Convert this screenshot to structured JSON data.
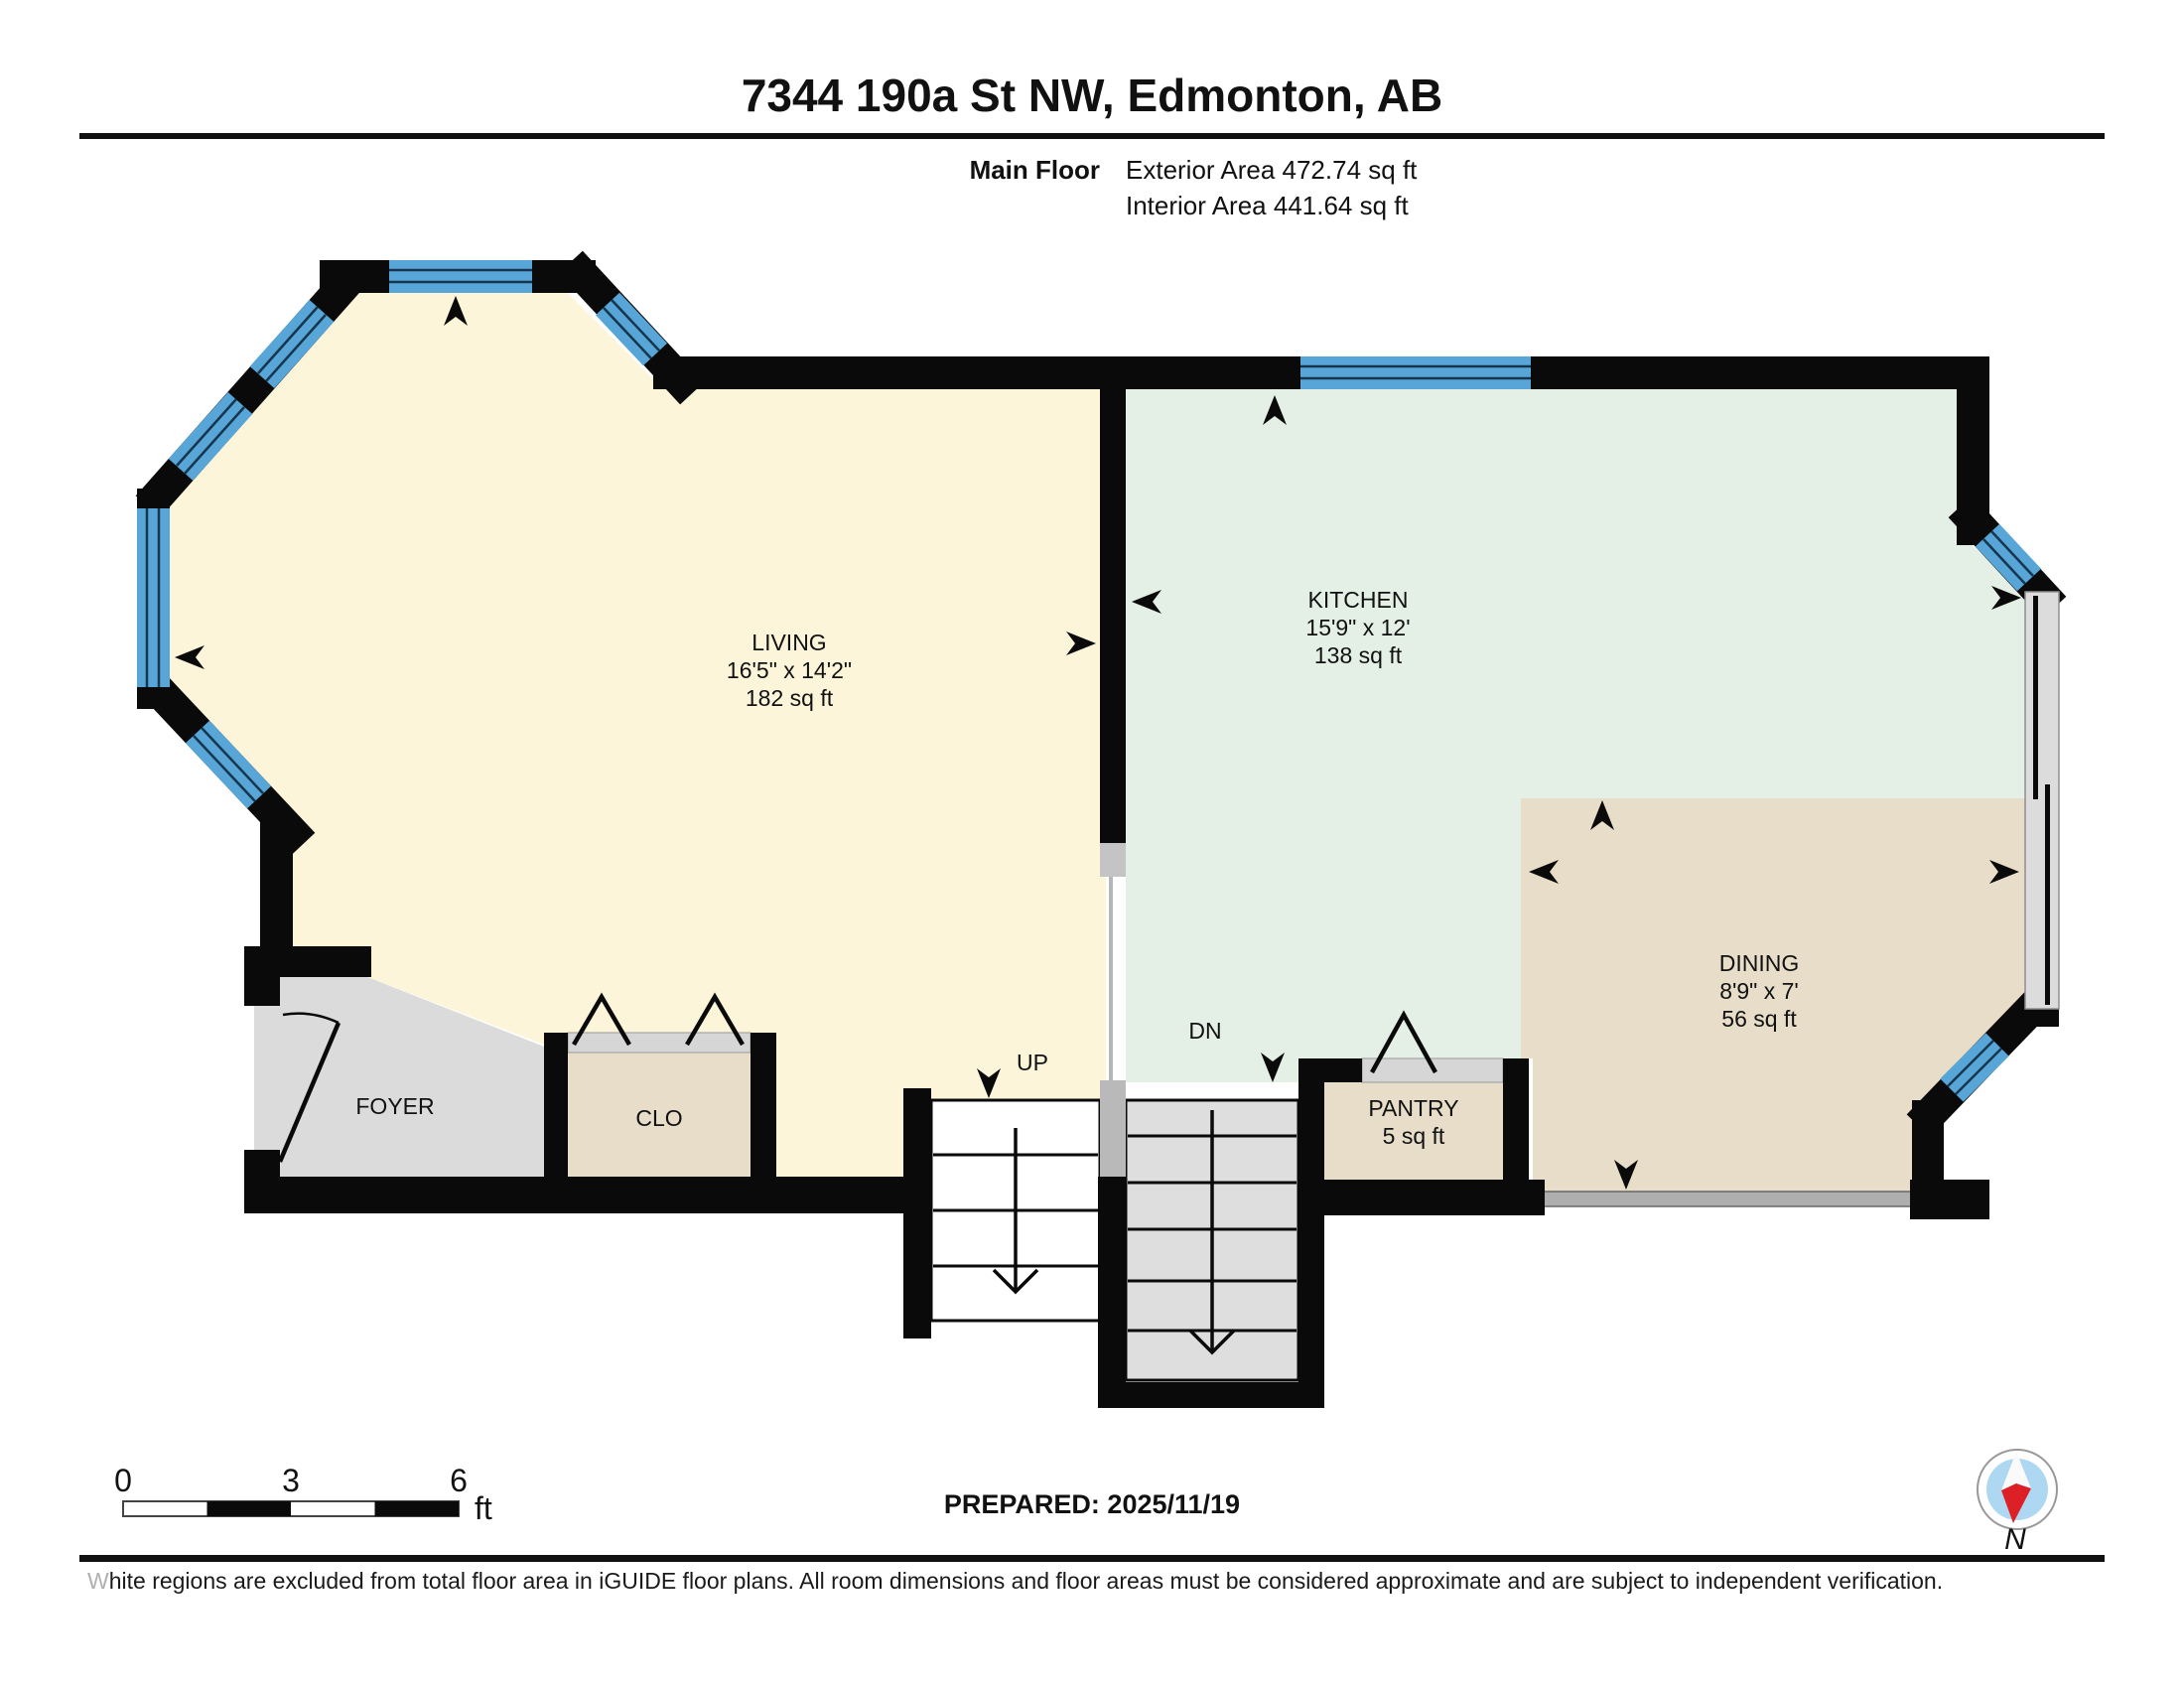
{
  "header": {
    "title": "7344 190a St NW, Edmonton, AB",
    "floor_label": "Main Floor",
    "exterior_area": "Exterior Area 472.74 sq ft",
    "interior_area": "Interior Area 441.64 sq ft"
  },
  "rooms": {
    "living": {
      "name": "LIVING",
      "dimensions": "16'5\" x 14'2\"",
      "area": "182 sq ft"
    },
    "kitchen": {
      "name": "KITCHEN",
      "dimensions": "15'9\" x 12'",
      "area": "138 sq ft"
    },
    "dining": {
      "name": "DINING",
      "dimensions": "8'9\" x 7'",
      "area": "56 sq ft"
    },
    "foyer": {
      "name": "FOYER"
    },
    "closet": {
      "name": "CLO"
    },
    "pantry": {
      "name": "PANTRY",
      "area": "5 sq ft"
    }
  },
  "stairs": {
    "up_label": "UP",
    "down_label": "DN"
  },
  "scale_bar": {
    "start": "0",
    "mid": "3",
    "end": "6",
    "unit": "ft"
  },
  "footer": {
    "prepared": "PREPARED: 2025/11/19",
    "compass_label": "N",
    "disclaimer_first_letter": "W",
    "disclaimer_rest": "hite regions are excluded from total floor area in iGUIDE floor plans. All room dimensions and floor areas must be considered approximate and are subject to independent verification."
  },
  "colors": {
    "wall": "#0a0a0a",
    "window_blue": "#58a5d8",
    "living_fill": "#fcf5da",
    "kitchen_fill": "#e4efe6",
    "dining_fill": "#e7ddc8",
    "closet_fill": "#e7ddc8",
    "pantry_fill": "#e7ddc8",
    "foyer_fill": "#dbdbdb",
    "stair_up_fill": "#ffffff",
    "stair_dn_fill": "#dedede",
    "door_track": "#d6d6d6",
    "rail_gray": "#aeaeae",
    "compass_red": "#dd1f26",
    "compass_blue": "#aed7f2"
  }
}
